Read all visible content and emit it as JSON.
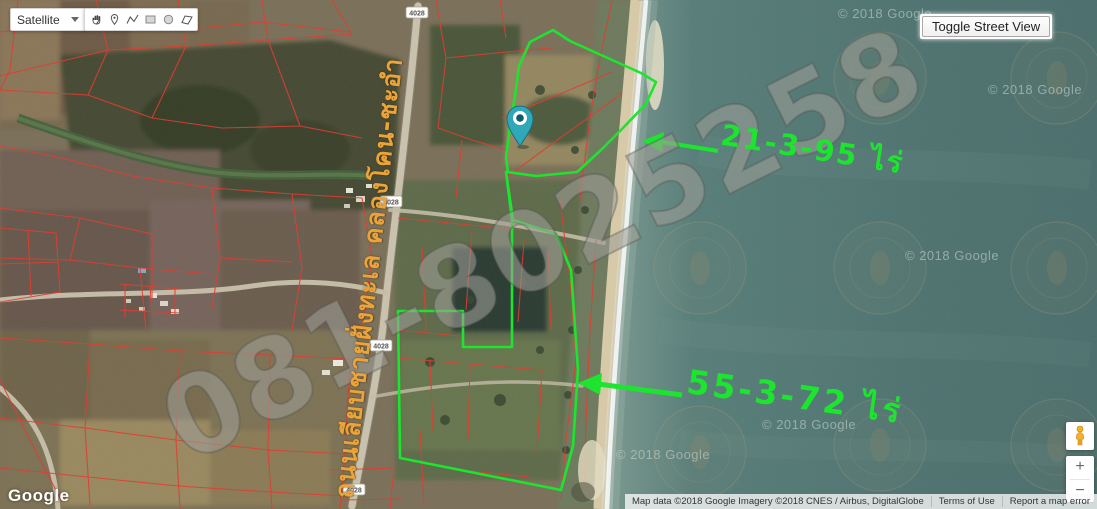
{
  "controls": {
    "map_type": {
      "label": "Satellite"
    },
    "drawing_tools": [
      "pan-hand",
      "place-marker",
      "polyline",
      "rectangle",
      "circle",
      "polygon"
    ],
    "street_view_toggle": {
      "label": "Toggle Street View"
    },
    "zoom": {
      "in_label": "+",
      "out_label": "−"
    }
  },
  "map": {
    "road_shield": "4028",
    "marker_icon": "teal-location-pin",
    "colors": {
      "annotation_green": "#1de42f",
      "road_label_gold": "#eca43a",
      "cadastral_red": "#e03a2e",
      "sea": "#4f7370",
      "marker_teal": "#2fa9b8"
    }
  },
  "annotations": {
    "parcel_upper_label": "21-3-95 ไร่",
    "parcel_lower_label": "55-3-72 ไร่",
    "road_name": "ถนนเลียบชายฝั่งทะเล คลองโคน-ชะอำ",
    "phone_watermark": "081-8025258"
  },
  "watermarks": {
    "copyright": "© 2018 Google"
  },
  "attribution": {
    "logo": "Google",
    "map_data": "Map data ©2018 Google",
    "imagery": "Imagery ©2018 CNES / Airbus, DigitalGlobe",
    "terms": "Terms of Use",
    "report_error": "Report a map error"
  }
}
